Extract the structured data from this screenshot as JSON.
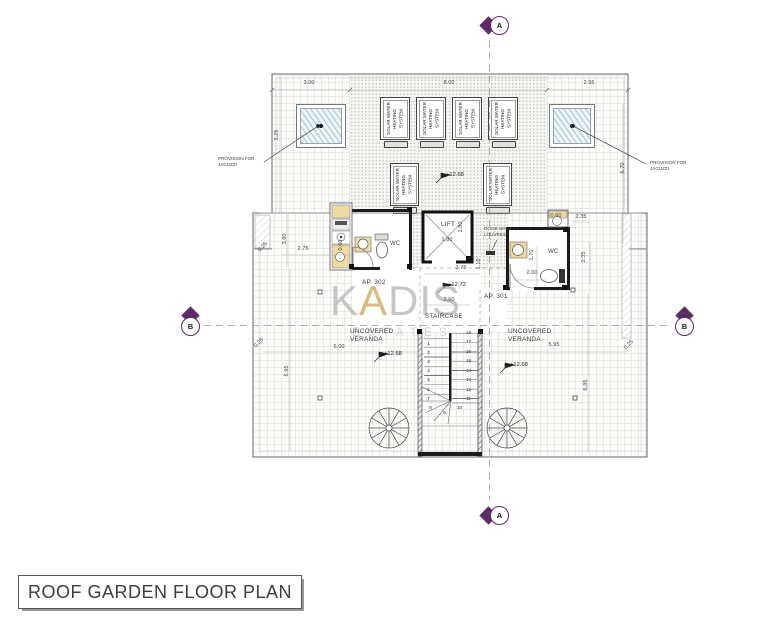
{
  "title": "ROOF GARDEN FLOOR PLAN",
  "watermark": {
    "name_pre": "K",
    "name_accent": "A",
    "name_post": "DIS",
    "tagline": "ESTATES"
  },
  "markers": {
    "a": "A",
    "b": "B"
  },
  "labels": {
    "jacuzzi_note": "PROVISION FOR\nJACUZZI",
    "solar_panel": "SOLAR WATER\nHEATING SYSTEM",
    "lift": "LIFT",
    "louvre_note": "DOOR WITH\nLOUVRES",
    "wc": "WC",
    "ap302": "AP. 302",
    "ap301": "AP. 301",
    "staircase": "STAIRCASE",
    "veranda": "UNCOVERED\nVERANDA"
  },
  "levels": {
    "solar_deck": "+12.68",
    "landing": "+12.72",
    "veranda_left": "+12.68",
    "veranda_right": "+12.68"
  },
  "dimensions": {
    "top_left_bay": "3.00",
    "top_middle_bay": "8.00",
    "top_right_bay": "2.95",
    "left_bay_depth": "5.25",
    "right_bay_depth": "6.70",
    "left_parapet": "0.25",
    "left_room_depth": "3.80",
    "left_room_width": "2.75",
    "left_cabinet": "0.60",
    "lift_width": "1.80",
    "lift_depth": "1.80",
    "core_width": "3.75",
    "core_offset": "1.10",
    "landing_depth": "2.50",
    "right_cabinet": "0.60",
    "right_room_top": "2.35",
    "right_room_side": "2.35",
    "right_wc_depth": "1.70",
    "right_wc_width": "2.00",
    "bottom_left_parapet": "0.25",
    "veranda_left_width": "6.00",
    "veranda_left_depth": "6.95",
    "veranda_right_width": "5.95",
    "veranda_right_depth": "6.95",
    "bottom_right_parapet": "0.25"
  },
  "stairs": {
    "numbers": [
      "1",
      "2",
      "3",
      "4",
      "5",
      "6",
      "7",
      "8",
      "9",
      "10",
      "11",
      "12",
      "13",
      "14",
      "15",
      "16",
      "17",
      "18"
    ]
  },
  "colors": {
    "marker_purple": "#5e2b69",
    "watermark_gold": "#d0a95c",
    "cabinet_tan": "#ecd9a4",
    "wall_black": "#1c1c1c"
  }
}
